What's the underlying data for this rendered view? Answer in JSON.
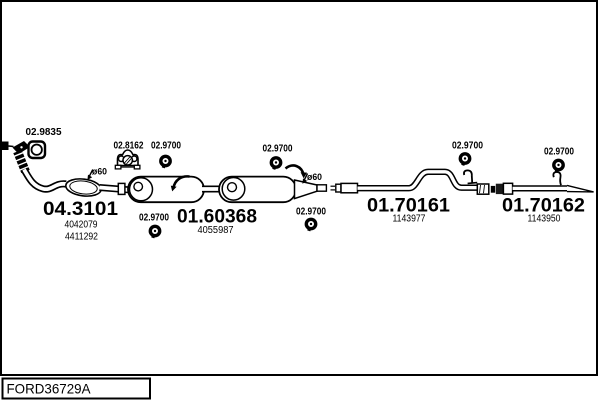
{
  "diagram": {
    "code": "FORD36729A",
    "parts": [
      {
        "id": "04.3101",
        "oem_numbers": [
          "4042079",
          "4411292"
        ]
      },
      {
        "id": "01.60368",
        "oem_numbers": [
          "4055987"
        ]
      },
      {
        "id": "01.70161",
        "oem_numbers": [
          "1143977"
        ]
      },
      {
        "id": "01.70162",
        "oem_numbers": [
          "1143950"
        ]
      }
    ],
    "fittings": {
      "gasket": {
        "id": "02.9835"
      },
      "rubber_hanger": {
        "id": "02.8162"
      },
      "clamps": [
        {
          "id": "02.9700"
        },
        {
          "id": "02.9700"
        },
        {
          "id": "02.9700"
        },
        {
          "id": "02.9700"
        },
        {
          "id": "02.9700"
        },
        {
          "id": "02.9700"
        }
      ]
    },
    "annotations": {
      "diameters": [
        {
          "text": "ø60"
        },
        {
          "text": "ø60"
        }
      ]
    },
    "colors": {
      "ink": "#000000",
      "background": "#ffffff"
    }
  }
}
